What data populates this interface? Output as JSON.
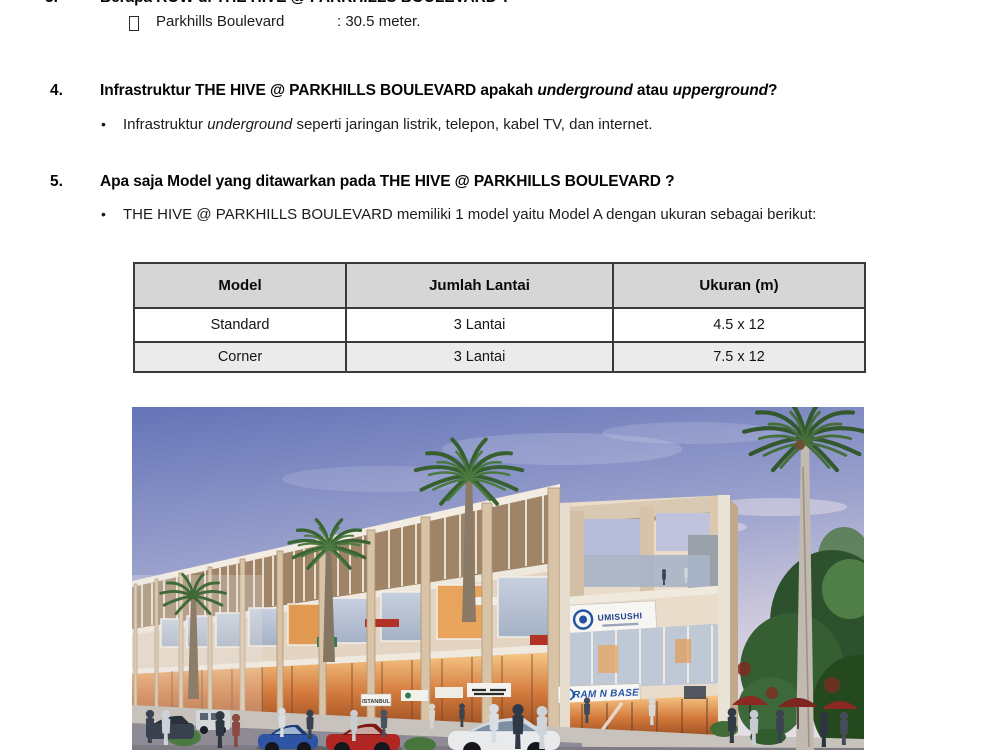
{
  "page": {
    "width": 1000,
    "height": 750,
    "background": "#ffffff",
    "type": "scanned FAQ document page"
  },
  "bullet_char": "•",
  "document": {
    "q3": {
      "number": "3.",
      "question": "Berapa ROW di THE HIVE @ PARKHILLS BOULEVARD ?",
      "answer_label": "Parkhills Boulevard",
      "answer_value": ": 30.5 meter."
    },
    "q4": {
      "number": "4.",
      "q_pre": "Infrastruktur THE HIVE @ PARKHILLS BOULEVARD apakah ",
      "q_italic1": "underground",
      "q_mid": " atau ",
      "q_italic2": "upperground",
      "q_post": "?",
      "bullet_pre": "Infrastruktur ",
      "bullet_italic": "underground",
      "bullet_post": " seperti jaringan listrik, telepon, kabel TV, dan internet."
    },
    "q5": {
      "number": "5.",
      "question": "Apa saja Model yang ditawarkan pada THE HIVE @ PARKHILLS BOULEVARD ?",
      "bullet": "THE HIVE @ PARKHILLS BOULEVARD memiliki 1 model yaitu Model A dengan ukuran sebagai berikut:"
    }
  },
  "table": {
    "headers": [
      "Model",
      "Jumlah Lantai",
      "Ukuran (m)"
    ],
    "rows": [
      [
        "Standard",
        "3 Lantai",
        "4.5 x 12"
      ],
      [
        "Corner",
        "3 Lantai",
        "7.5 x 12"
      ]
    ],
    "header_bg": "#d6d6d6",
    "row_alt_bg": "#ebebeb",
    "border_color": "#3a3a3a"
  },
  "figure": {
    "description": "Artist rendering of a three-storey shophouse row with palm trees, pedestrians, parked cars and cafe umbrellas at dusk",
    "signs": {
      "umisushi": "UMISUSHI",
      "ramen": "RAM N BASE",
      "istanbul": "ISTANBUL"
    },
    "palette": {
      "sky_top": "#6574b8",
      "sky_horizon": "#e4dee6",
      "facade": "#d7c4a8",
      "window_glow": "#f2a85c",
      "sign_blue": "#2456a8",
      "palm_green": "#3a6433",
      "umbrella_red": "#8a2a22",
      "road": "#8e8b94"
    }
  }
}
